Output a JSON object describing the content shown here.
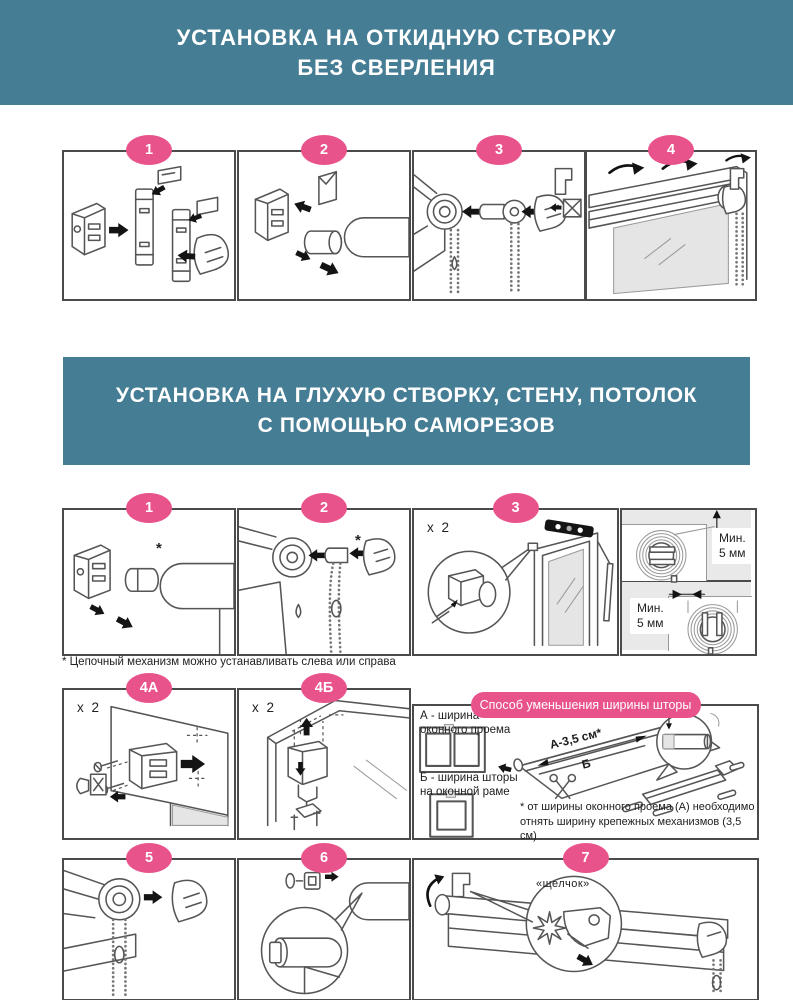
{
  "colors": {
    "teal": "#457D94",
    "pink": "#E9538C",
    "border": "#4B4B4B",
    "panel": "#E9E9E9"
  },
  "banner1": {
    "line1": "УСТАНОВКА НА ОТКИДНУЮ СТВОРКУ",
    "line2": "БЕЗ СВЕРЛЕНИЯ"
  },
  "banner2": {
    "line1": "УСТАНОВКА НА ГЛУХУЮ СТВОРКУ, СТЕНУ, ПОТОЛОК",
    "line2": "С ПОМОЩЬЮ САМОРЕЗОВ"
  },
  "row1": {
    "badges": [
      "1",
      "2",
      "3",
      "4"
    ]
  },
  "row2": {
    "badges": [
      "1",
      "2",
      "3"
    ],
    "asterisk": "*",
    "count_label": "x 2",
    "clearance_top": {
      "line1": "Мин.",
      "line2": "5 мм"
    },
    "clearance_side": {
      "line1": "Мин.",
      "line2": "5 мм"
    }
  },
  "footnote1": "* Цепочный механизм можно устанавливать слева или справа",
  "row3": {
    "badge_a": "4А",
    "badge_b": "4Б",
    "count_label_a": "x 2",
    "count_label_b": "x 2",
    "pill_title": "Способ уменьшения ширины шторы",
    "label_a_line1": "А - ширина",
    "label_a_line2": "оконного проема",
    "label_b_line1": "Б - ширина шторы",
    "label_b_line2": "на оконной раме",
    "width_label": "А-3,5 см*",
    "width_sublabel": "Б",
    "mm_label": "5 мм",
    "footnote_line1": "* от ширины оконного проема (А) необходимо",
    "footnote_line2": "отнять ширину крепежных механизмов (3,5 см)"
  },
  "row4": {
    "badges": [
      "5",
      "6",
      "7"
    ],
    "click_label": "«щелчок»"
  }
}
